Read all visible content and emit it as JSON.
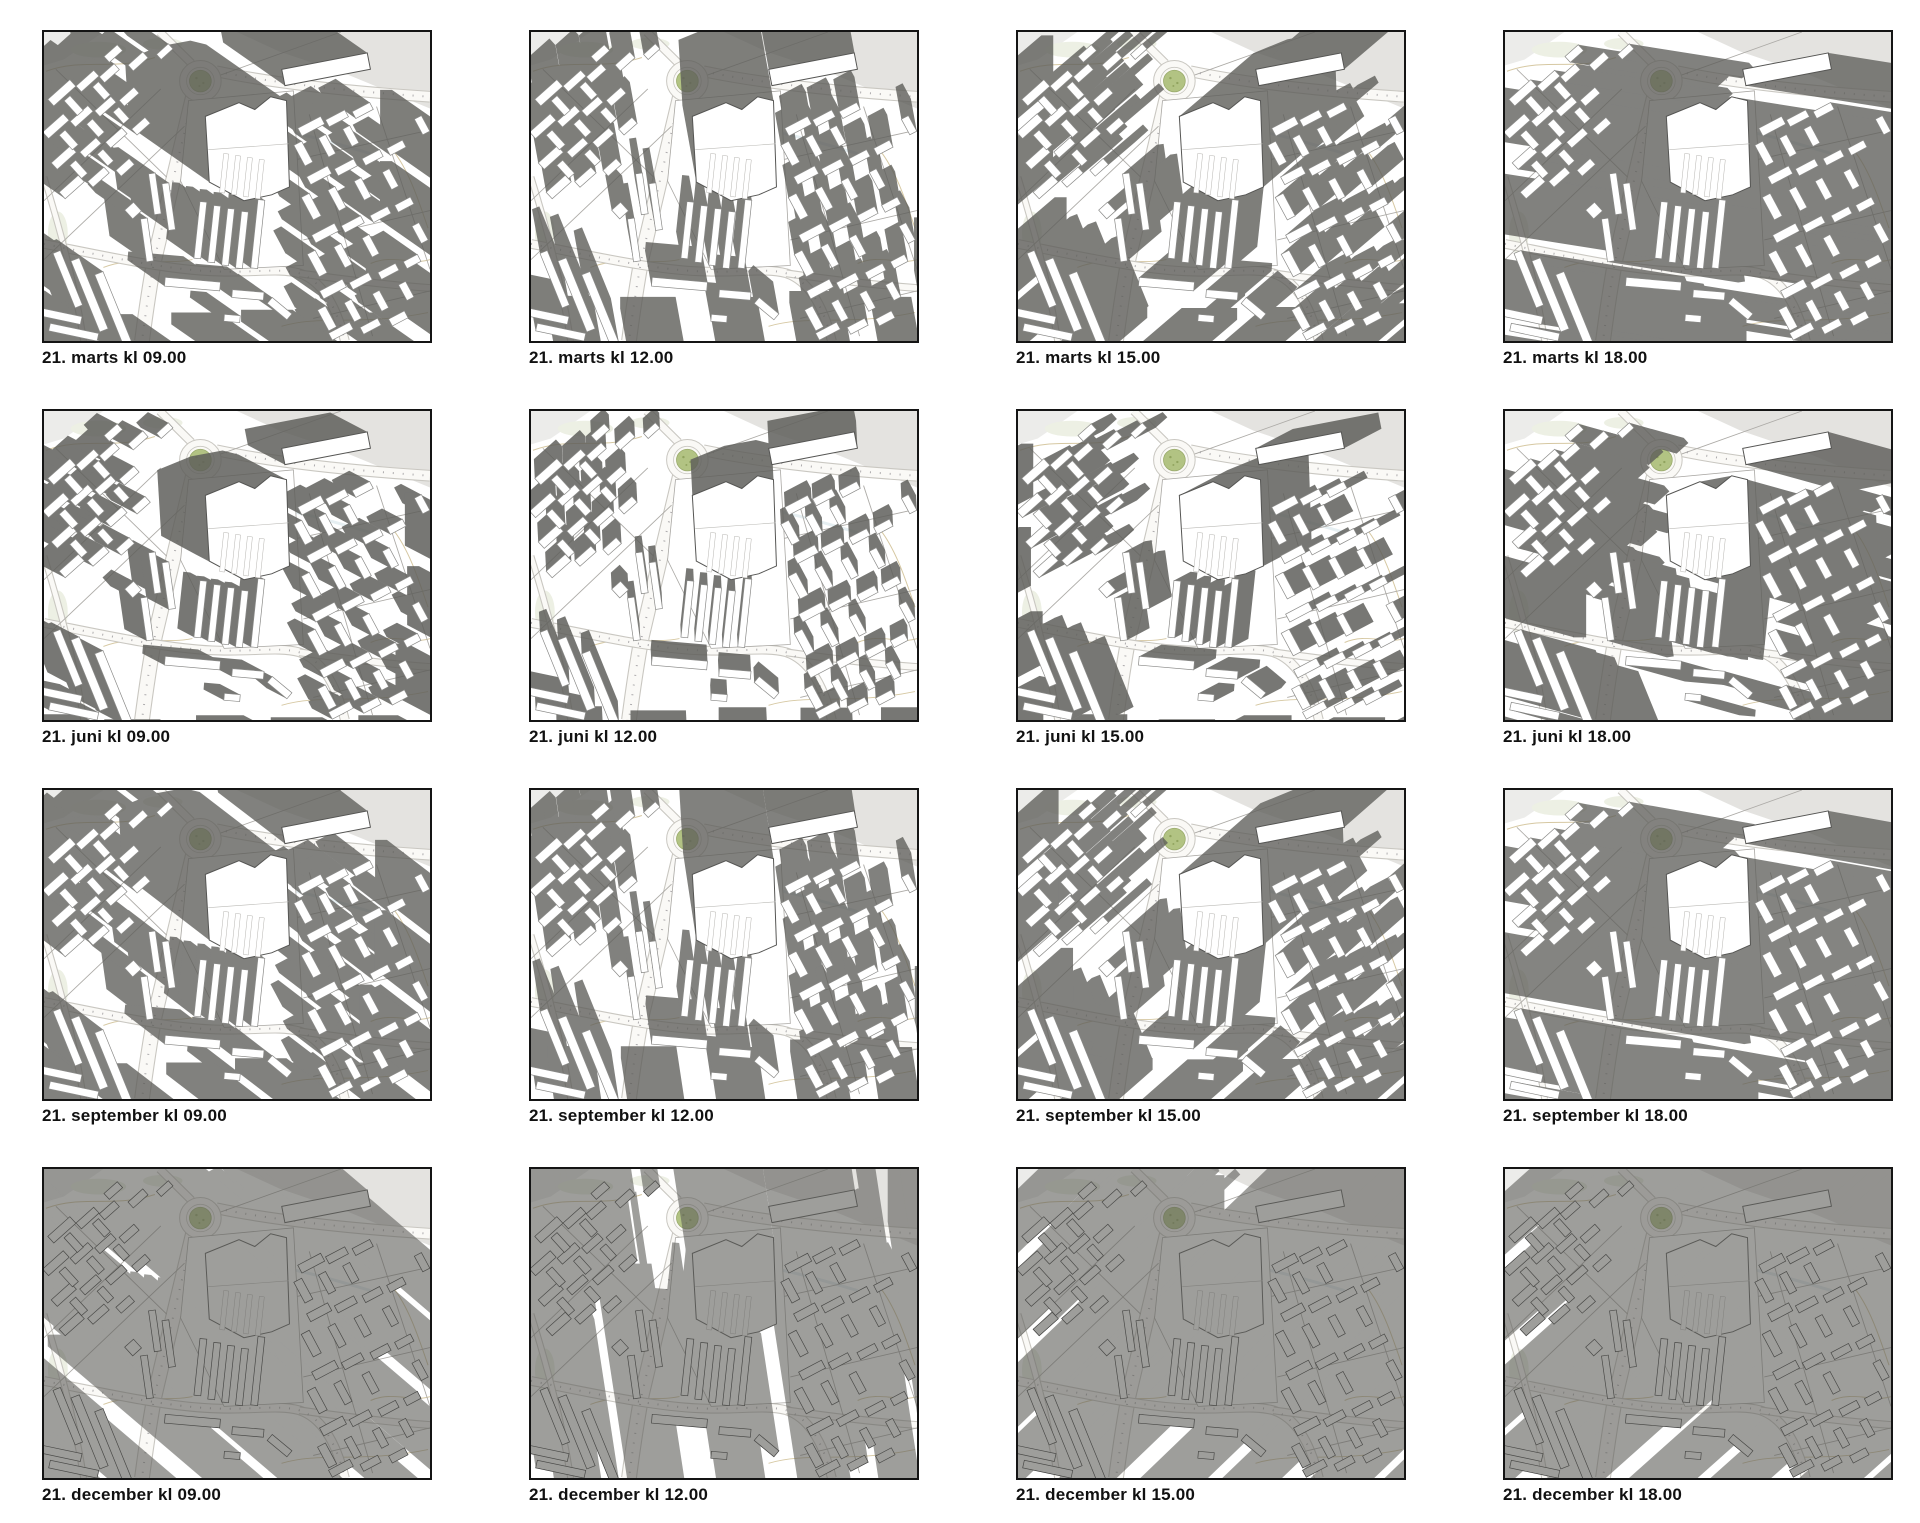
{
  "colors": {
    "shadow": "#5e5e5a",
    "building_fill": "#ffffff",
    "building_outline": "#8a8a88",
    "building_outline_winter": "#2a2a2a",
    "tall_outline": "#555553",
    "road_fill": "#faf9f6",
    "road_edge": "#c9c7c1",
    "thin_line": "#adaba7",
    "road_dots": "#98969a",
    "gray_zone": "#e4e3e0",
    "gray_zone_light": "#ececea",
    "contour": "#d6c8a2",
    "lawn": "#edf0e4",
    "roundabout_green": "#b2c383",
    "roundabout_green_edge": "#9aab6c",
    "frame_border": "#141414",
    "label_color": "#111111"
  },
  "rows": [
    {
      "date": "21. marts",
      "panels": [
        {
          "label": "21. marts kl 09.00",
          "time": "09.00",
          "shadow": {
            "dx": -0.78,
            "dy": -0.55,
            "len": 40,
            "opacity": 0.8,
            "on_top": false
          }
        },
        {
          "label": "21. marts kl 12.00",
          "time": "12.00",
          "shadow": {
            "dx": -0.18,
            "dy": -1.0,
            "len": 30,
            "opacity": 0.8,
            "on_top": false
          }
        },
        {
          "label": "21. marts kl 15.00",
          "time": "15.00",
          "shadow": {
            "dx": 0.72,
            "dy": -0.62,
            "len": 40,
            "opacity": 0.8,
            "on_top": false
          }
        },
        {
          "label": "21. marts kl 18.00",
          "time": "18.00",
          "shadow": {
            "dx": 1.0,
            "dy": 0.16,
            "len": 110,
            "opacity": 0.78,
            "on_top": false
          }
        }
      ]
    },
    {
      "date": "21. juni",
      "panels": [
        {
          "label": "21. juni kl 09.00",
          "time": "09.00",
          "shadow": {
            "dx": -0.85,
            "dy": -0.45,
            "len": 22,
            "opacity": 0.84,
            "on_top": false
          }
        },
        {
          "label": "21. juni kl 12.00",
          "time": "12.00",
          "shadow": {
            "dx": -0.05,
            "dy": -1.0,
            "len": 14,
            "opacity": 0.84,
            "on_top": false
          }
        },
        {
          "label": "21. juni kl 15.00",
          "time": "15.00",
          "shadow": {
            "dx": 0.85,
            "dy": -0.45,
            "len": 22,
            "opacity": 0.84,
            "on_top": false
          }
        },
        {
          "label": "21. juni kl 18.00",
          "time": "18.00",
          "shadow": {
            "dx": 1.0,
            "dy": 0.28,
            "len": 50,
            "opacity": 0.82,
            "on_top": false
          }
        }
      ]
    },
    {
      "date": "21. september",
      "panels": [
        {
          "label": "21. september kl 09.00",
          "time": "09.00",
          "shadow": {
            "dx": -0.75,
            "dy": -0.58,
            "len": 45,
            "opacity": 0.78,
            "on_top": false
          }
        },
        {
          "label": "21. september kl 12.00",
          "time": "12.00",
          "shadow": {
            "dx": -0.15,
            "dy": -1.0,
            "len": 34,
            "opacity": 0.78,
            "on_top": false
          }
        },
        {
          "label": "21. september kl 15.00",
          "time": "15.00",
          "shadow": {
            "dx": 0.7,
            "dy": -0.62,
            "len": 45,
            "opacity": 0.78,
            "on_top": false
          }
        },
        {
          "label": "21. september kl 18.00",
          "time": "18.00",
          "shadow": {
            "dx": 1.0,
            "dy": 0.18,
            "len": 115,
            "opacity": 0.76,
            "on_top": false
          }
        }
      ]
    },
    {
      "date": "21. december",
      "panels": [
        {
          "label": "21. december kl 09.00",
          "time": "09.00",
          "shadow": {
            "dx": -0.72,
            "dy": -0.62,
            "len": 130,
            "opacity": 0.6,
            "on_top": true
          }
        },
        {
          "label": "21. december kl 12.00",
          "time": "12.00",
          "shadow": {
            "dx": -0.15,
            "dy": -0.99,
            "len": 110,
            "opacity": 0.6,
            "on_top": true
          }
        },
        {
          "label": "21. december kl 15.00",
          "time": "15.00",
          "shadow": {
            "dx": 0.68,
            "dy": -0.66,
            "len": 140,
            "opacity": 0.6,
            "on_top": true
          }
        },
        {
          "label": "21. december kl 18.00",
          "time": "18.00",
          "shadow": {
            "dx": 0.8,
            "dy": -0.72,
            "len": 230,
            "opacity": 0.6,
            "on_top": true
          }
        }
      ]
    }
  ]
}
